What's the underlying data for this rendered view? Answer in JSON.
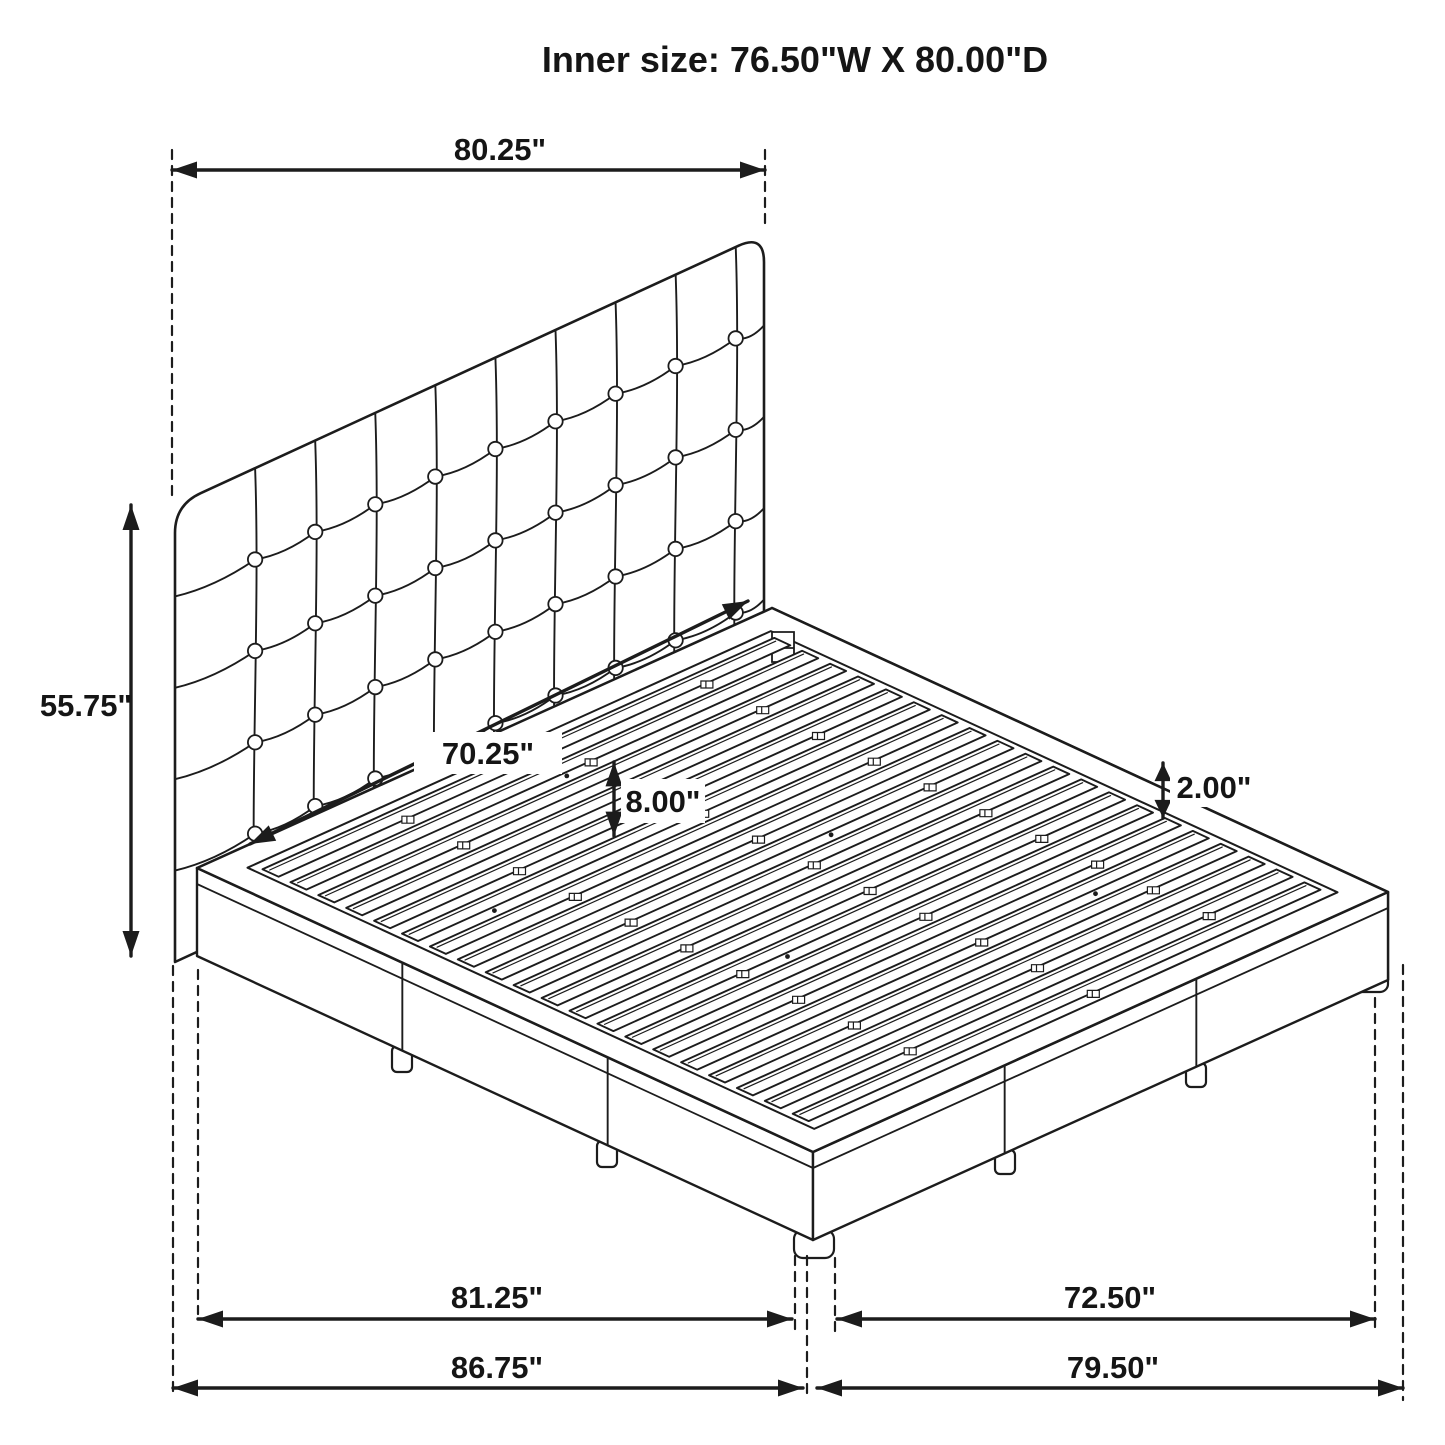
{
  "title": "Inner size: 76.50\"W X 80.00\"D",
  "dimensions": {
    "headboard_width": "80.25\"",
    "headboard_height": "55.75\"",
    "inner_width": "70.25\"",
    "base_height": "8.00\"",
    "slat_thickness": "2.00\"",
    "left_rail_length": "81.25\"",
    "right_rail_length": "72.50\"",
    "overall_depth_left": "86.75\"",
    "overall_depth_right": "79.50\""
  },
  "colors": {
    "line": "#1c1c1c",
    "background": "#ffffff"
  }
}
